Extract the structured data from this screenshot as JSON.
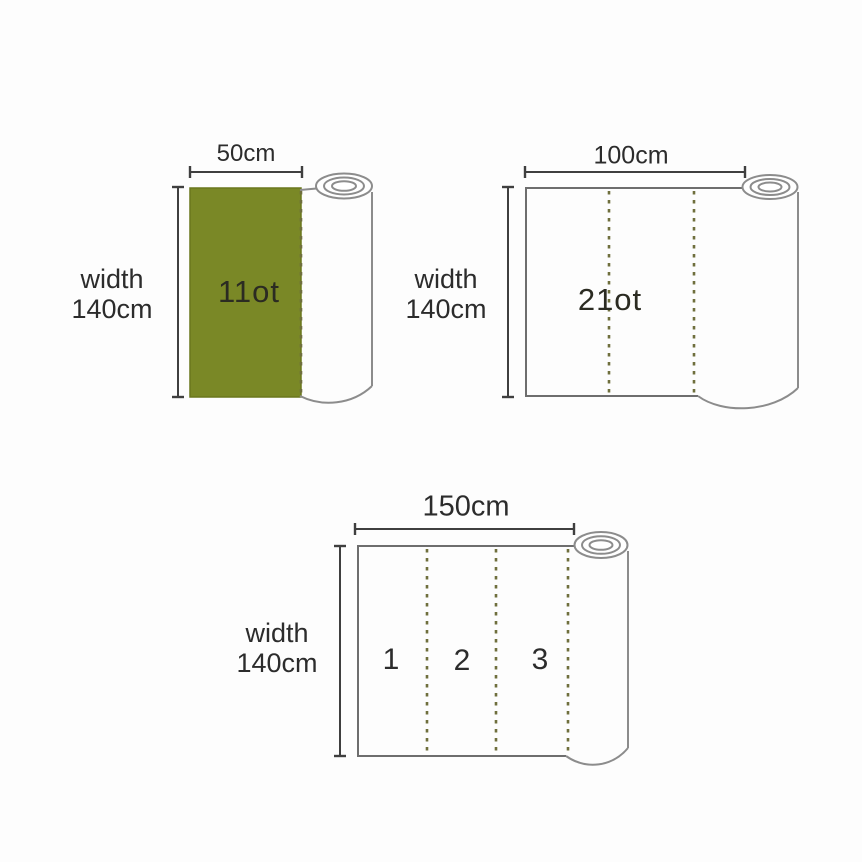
{
  "diagram": {
    "description_labels": {
      "width_word": "width",
      "width_value": "140cm"
    },
    "rolls": [
      {
        "length_label": "50cm",
        "width_line1": "width",
        "width_line2": "140cm",
        "lot_label": "11ot"
      },
      {
        "length_label": "100cm",
        "width_line1": "width",
        "width_line2": "140cm",
        "lot_label": "21ot"
      },
      {
        "length_label": "150cm",
        "width_line1": "width",
        "width_line2": "140cm",
        "sections": [
          "1",
          "2",
          "3"
        ]
      }
    ],
    "colors": {
      "fabric_green": "#7a8826",
      "fabric_green_edge": "#6a771d",
      "dash_olive": "#6f6f3d",
      "roll_outline_gray": "#8c8c8c",
      "rect_outline_gray": "#6e6e6e",
      "dimension_line": "#3f3f3f",
      "text": "#2c2c2c",
      "background": "#fdfdfd"
    }
  }
}
